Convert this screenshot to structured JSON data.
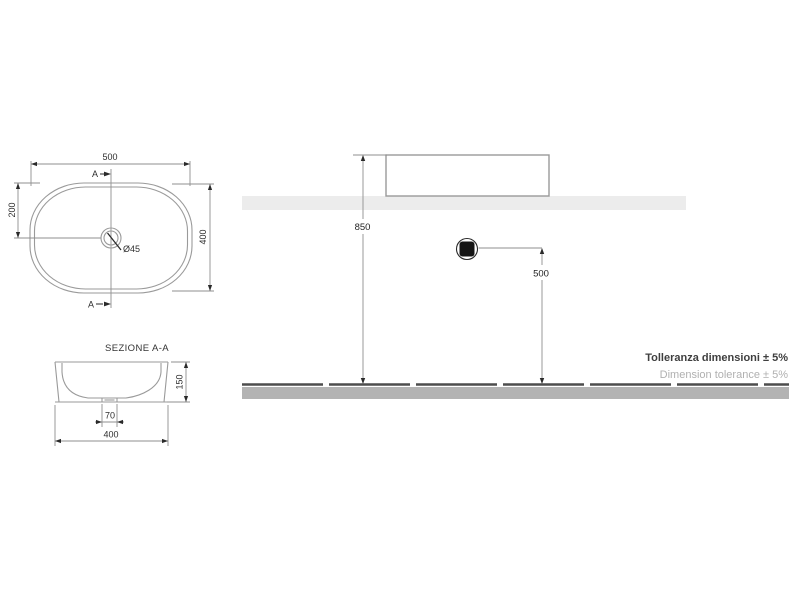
{
  "plan_view": {
    "dim_width": "500",
    "dim_height": "400",
    "dim_center_from_top": "200",
    "drain_diameter": "Ø45",
    "section_marker_top": "A",
    "section_marker_bottom": "A"
  },
  "section_view": {
    "title": "SEZIONE A-A",
    "dim_height": "150",
    "dim_drain_width": "70",
    "dim_width": "400"
  },
  "elevation_view": {
    "dim_rim_height": "850",
    "dim_drain_outlet_height": "500"
  },
  "footnotes": {
    "tolerance_primary": "Tolleranza dimensioni ± 5%",
    "tolerance_secondary": "Dimension tolerance ± 5%"
  },
  "colors": {
    "drawing_line": "#8f8f8f",
    "counter_band": "#ececec",
    "floor_band": "#b3b3b3",
    "floor_edge": "#4d4d4d",
    "drain_fill": "#151515",
    "note_primary": "#3f3f3f",
    "note_secondary": "#b0b0b0"
  }
}
